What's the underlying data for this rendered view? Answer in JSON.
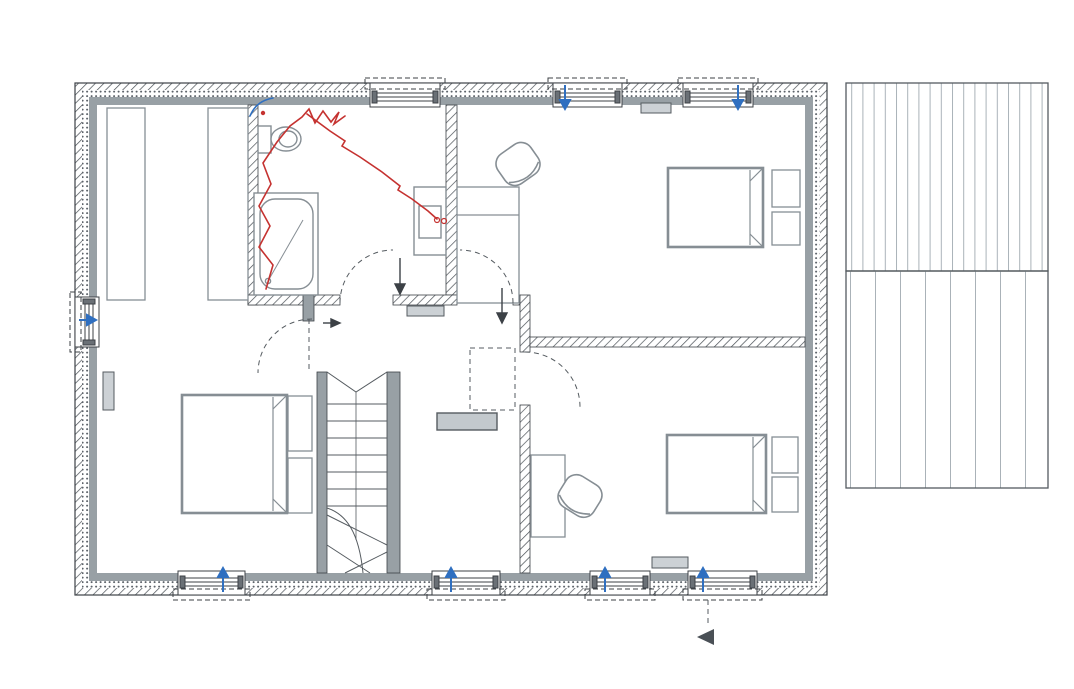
{
  "rooms": {
    "sdb": {
      "name": "SDB",
      "hs": "HS plaf. : 2.40",
      "area": "8,06 m²"
    },
    "chambre3": {
      "name": "CHAMBRE 3",
      "hs": "HS plaf. : 2.40",
      "area": "16,30 m²"
    },
    "chambre1": {
      "name_line1": "CHAMBRE 1",
      "name_line2": "+ DRESSING",
      "hs": "HS plaf. : 2.40",
      "area": "18,08 m²"
    },
    "hall": {
      "name": "HALL DE NUIT",
      "hs": "HS plaf. : 2.40",
      "area": "7,93 m²"
    },
    "coin_bureau": {
      "name": "COIN BUREAU",
      "hs": "HS plaf. : 2.40"
    },
    "chambre2": {
      "name": "CHAMBRE 2",
      "hs": "HS plaf. : 2.40",
      "area": "13,52 m²"
    }
  },
  "annotations": {
    "level": "NIV. + 2.71",
    "attic_line1": "Accès",
    "attic_line2": "grenier",
    "ridge": "faîtage",
    "total_width": "1.100",
    "total_height": "750"
  },
  "colors": {
    "wall_gray": "#98a0a5",
    "radiator_fill": "#ccd1d5",
    "marker_red": "#c53230",
    "marker_blue": "#2f6fc0",
    "level_box": "#c3c9cd"
  },
  "labels": [
    {
      "t": "432",
      "x": 237,
      "y": 34
    },
    {
      "t": "90",
      "x": 404,
      "y": 27
    },
    {
      "t": "95",
      "x": 404,
      "y": 40
    },
    {
      "t": "181",
      "x": 500,
      "y": 34
    },
    {
      "t": "90",
      "x": 589,
      "y": 27
    },
    {
      "t": "95",
      "x": 589,
      "y": 40
    },
    {
      "t": "100",
      "x": 650,
      "y": 34
    },
    {
      "t": "90",
      "x": 718,
      "y": 27
    },
    {
      "t": "95",
      "x": 718,
      "y": 40
    },
    {
      "t": "117",
      "x": 792,
      "y": 34
    },
    {
      "t": "37",
      "x": 95,
      "y": 59
    },
    {
      "t": "210",
      "x": 176,
      "y": 59
    },
    {
      "t": "10",
      "x": 251,
      "y": 49
    },
    {
      "t": "290",
      "x": 355,
      "y": 59
    },
    {
      "t": "10",
      "x": 458,
      "y": 49
    },
    {
      "t": "506",
      "x": 635,
      "y": 59
    },
    {
      "t": "37",
      "x": 810,
      "y": 59
    },
    {
      "t": "14",
      "x": 322,
      "y": 617
    },
    {
      "t": "10",
      "x": 522,
      "y": 617
    },
    {
      "t": "37",
      "x": 95,
      "y": 632
    },
    {
      "t": "310",
      "x": 213,
      "y": 632
    },
    {
      "t": "286",
      "x": 424,
      "y": 632
    },
    {
      "t": "406",
      "x": 664,
      "y": 632
    },
    {
      "t": "37",
      "x": 815,
      "y": 632
    },
    {
      "t": "147",
      "x": 132,
      "y": 651
    },
    {
      "t": "90",
      "x": 210,
      "y": 645
    },
    {
      "t": "95",
      "x": 210,
      "y": 658
    },
    {
      "t": "284",
      "x": 338,
      "y": 651
    },
    {
      "t": "90",
      "x": 464,
      "y": 645
    },
    {
      "t": "95",
      "x": 464,
      "y": 658
    },
    {
      "t": "139",
      "x": 545,
      "y": 651
    },
    {
      "t": "90",
      "x": 620,
      "y": 645
    },
    {
      "t": "95",
      "x": 620,
      "y": 658
    },
    {
      "t": "60",
      "x": 671,
      "y": 651
    },
    {
      "t": "14",
      "x": 703,
      "y": 651,
      "r": -90
    },
    {
      "t": "90",
      "x": 723,
      "y": 645
    },
    {
      "t": "95",
      "x": 723,
      "y": 658
    },
    {
      "t": "110",
      "x": 790,
      "y": 651
    },
    {
      "t": "1.100",
      "x": 455,
      "y": 677
    },
    {
      "t": "37",
      "x": 51,
      "y": 97,
      "r": -90
    },
    {
      "t": "330",
      "x": 31,
      "y": 181,
      "r": -90
    },
    {
      "t": "90",
      "x": 25,
      "y": 313,
      "r": -90
    },
    {
      "t": "215",
      "x": 36,
      "y": 316,
      "r": -90
    },
    {
      "t": "676",
      "x": 52,
      "y": 318,
      "r": -90
    },
    {
      "t": "330",
      "x": 31,
      "y": 438,
      "r": -90
    },
    {
      "t": "37",
      "x": 51,
      "y": 528,
      "r": -90
    },
    {
      "t": "37",
      "x": 853,
      "y": 97,
      "r": -90
    },
    {
      "t": "333",
      "x": 853,
      "y": 212,
      "r": -90
    },
    {
      "t": "10",
      "x": 843,
      "y": 318,
      "r": -90
    },
    {
      "t": "750",
      "x": 879,
      "y": 318,
      "r": -90
    },
    {
      "t": "333",
      "x": 853,
      "y": 431,
      "r": -90
    },
    {
      "t": "37",
      "x": 856,
      "y": 536,
      "r": -90
    },
    {
      "t": "10",
      "x": 253,
      "y": 121
    },
    {
      "t": "170",
      "x": 311,
      "y": 131
    },
    {
      "t": "124",
      "x": 299,
      "y": 157,
      "r": -90
    },
    {
      "t": "100",
      "x": 408,
      "y": 127
    },
    {
      "t": "100",
      "x": 408,
      "y": 140
    },
    {
      "t": "20",
      "x": 442,
      "y": 124
    },
    {
      "t": "10",
      "x": 463,
      "y": 124
    },
    {
      "t": "141",
      "x": 507,
      "y": 131
    },
    {
      "t": "100",
      "x": 590,
      "y": 127
    },
    {
      "t": "100",
      "x": 590,
      "y": 140
    },
    {
      "t": "90",
      "x": 655,
      "y": 131
    },
    {
      "t": "100",
      "x": 718,
      "y": 127
    },
    {
      "t": "100",
      "x": 718,
      "y": 140
    },
    {
      "t": "75",
      "x": 779,
      "y": 131
    },
    {
      "t": "HT 200",
      "x": 750,
      "y": 155,
      "s": 9.5,
      "n": "height-note"
    },
    {
      "t": "limite plafond",
      "x": 576,
      "y": 184,
      "s": 10,
      "n": "ceiling-limit-note"
    },
    {
      "t": "288",
      "x": 131,
      "y": 210,
      "r": -90
    },
    {
      "t": "278",
      "x": 339,
      "y": 206,
      "r": -90
    },
    {
      "t": "278",
      "x": 554,
      "y": 209,
      "r": -90
    },
    {
      "t": "333",
      "x": 768,
      "y": 223,
      "r": -90
    },
    {
      "t": "14",
      "x": 289,
      "y": 198,
      "r": -90,
      "s": 9.5
    },
    {
      "t": "80",
      "x": 300,
      "y": 227,
      "r": -90
    },
    {
      "t": "10",
      "x": 252,
      "y": 266,
      "s": 10
    },
    {
      "t": "14",
      "x": 317,
      "y": 267,
      "s": 10
    },
    {
      "t": "20",
      "x": 339,
      "y": 269,
      "s": 10
    },
    {
      "t": "90",
      "x": 287,
      "y": 280,
      "s": 10
    },
    {
      "t": "60",
      "x": 303,
      "y": 279,
      "r": -90,
      "s": 10
    },
    {
      "t": "10",
      "x": 289,
      "y": 293,
      "r": -90,
      "s": 10
    },
    {
      "t": "80",
      "x": 366,
      "y": 272
    },
    {
      "t": "205",
      "x": 367,
      "y": 284
    },
    {
      "t": "86",
      "x": 427,
      "y": 280
    },
    {
      "t": "10",
      "x": 450,
      "y": 267
    },
    {
      "t": "5",
      "x": 466,
      "y": 267
    },
    {
      "t": "80",
      "x": 491,
      "y": 272
    },
    {
      "t": "205",
      "x": 492,
      "y": 284
    },
    {
      "t": "55",
      "x": 553,
      "y": 318,
      "r": -90
    },
    {
      "t": "10",
      "x": 541,
      "y": 331,
      "r": -90
    },
    {
      "t": "10",
      "x": 540,
      "y": 353,
      "s": 10
    },
    {
      "t": "702",
      "x": 566,
      "y": 359
    },
    {
      "t": "80",
      "x": 550,
      "y": 377,
      "r": -90
    },
    {
      "t": "205",
      "x": 562,
      "y": 377,
      "r": -90
    },
    {
      "t": "10",
      "x": 757,
      "y": 338,
      "r": -90
    },
    {
      "t": "10",
      "x": 288,
      "y": 317,
      "r": -90,
      "s": 10
    },
    {
      "t": "80",
      "x": 306,
      "y": 338,
      "r": -90
    },
    {
      "t": "205",
      "x": 317,
      "y": 338,
      "r": -90
    },
    {
      "t": "14",
      "x": 323,
      "y": 347,
      "s": 9.5
    },
    {
      "t": "100",
      "x": 281,
      "y": 359
    },
    {
      "t": "100",
      "x": 126,
      "y": 342,
      "r": -90
    },
    {
      "t": "220",
      "x": 137,
      "y": 342,
      "r": -90
    },
    {
      "t": "288",
      "x": 131,
      "y": 473,
      "r": -90
    },
    {
      "t": "298",
      "x": 300,
      "y": 471,
      "r": -90
    },
    {
      "t": "388",
      "x": 342,
      "y": 437,
      "r": -90
    },
    {
      "t": "243",
      "x": 553,
      "y": 489,
      "r": -90
    },
    {
      "t": "333",
      "x": 767,
      "y": 465,
      "r": -90
    },
    {
      "t": "155",
      "x": 381,
      "y": 551
    },
    {
      "t": "14",
      "x": 321,
      "y": 539,
      "s": 10
    },
    {
      "t": "HT 200",
      "x": 127,
      "y": 529,
      "s": 9.5,
      "n": "height-note"
    },
    {
      "t": "HT 200",
      "x": 748,
      "y": 530,
      "s": 9.5,
      "n": "height-note"
    },
    {
      "t": "limite plafond",
      "x": 482,
      "y": 501,
      "s": 10,
      "n": "ceiling-limit-note"
    },
    {
      "t": "105",
      "x": 145,
      "y": 553
    },
    {
      "t": "100",
      "x": 212,
      "y": 546
    },
    {
      "t": "100",
      "x": 212,
      "y": 559
    },
    {
      "t": "105",
      "x": 283,
      "y": 553
    },
    {
      "t": "100",
      "x": 467,
      "y": 546
    },
    {
      "t": "100",
      "x": 467,
      "y": 559
    },
    {
      "t": "31",
      "x": 507,
      "y": 552
    },
    {
      "t": "10",
      "x": 522,
      "y": 540,
      "r": -90
    },
    {
      "t": "88",
      "x": 556,
      "y": 554
    },
    {
      "t": "100",
      "x": 620,
      "y": 546
    },
    {
      "t": "100",
      "x": 620,
      "y": 559
    },
    {
      "t": "50",
      "x": 671,
      "y": 551
    },
    {
      "t": "100",
      "x": 724,
      "y": 546
    },
    {
      "t": "100",
      "x": 724,
      "y": 559
    },
    {
      "t": "68",
      "x": 780,
      "y": 553
    },
    {
      "t": "HA 45",
      "x": 413,
      "y": 107,
      "s": 9.5,
      "n": "window-label"
    },
    {
      "t": "HA 45",
      "x": 591,
      "y": 107,
      "s": 9.5,
      "n": "window-label"
    },
    {
      "t": "HA 45",
      "x": 714,
      "y": 106,
      "s": 9.5,
      "n": "window-label"
    },
    {
      "t": "HA 45",
      "x": 213,
      "y": 567,
      "s": 9.5,
      "n": "window-label"
    },
    {
      "t": "HA 45",
      "x": 477,
      "y": 568,
      "s": 9.5,
      "n": "window-label"
    },
    {
      "t": "HA 45",
      "x": 638,
      "y": 566,
      "s": 9.5,
      "n": "window-label"
    },
    {
      "t": "HA 45",
      "x": 735,
      "y": 569,
      "s": 9.5,
      "n": "window-label"
    },
    {
      "t": "R",
      "x": 656,
      "y": 111,
      "s": 8,
      "n": "radiator-label"
    },
    {
      "t": "R",
      "x": 425,
      "y": 314,
      "s": 8,
      "n": "radiator-label"
    },
    {
      "t": "R",
      "x": 670,
      "y": 566,
      "s": 8,
      "n": "radiator-label"
    },
    {
      "t": "R",
      "x": 109,
      "y": 392,
      "s": 8,
      "r": -90,
      "n": "radiator-label"
    }
  ],
  "stairs": {
    "steps": [
      {
        "t": "14",
        "x": 354,
        "y": 388
      },
      {
        "t": "13",
        "x": 354,
        "y": 404
      },
      {
        "t": "12",
        "x": 354,
        "y": 421
      },
      {
        "t": "11",
        "x": 354,
        "y": 437
      },
      {
        "t": "10",
        "x": 354,
        "y": 453
      },
      {
        "t": "9",
        "x": 354,
        "y": 470
      },
      {
        "t": "8",
        "x": 354,
        "y": 486
      },
      {
        "t": "7",
        "x": 352,
        "y": 502
      },
      {
        "t": "6",
        "x": 354,
        "y": 518
      },
      {
        "t": "5",
        "x": 356,
        "y": 533
      },
      {
        "t": "4",
        "x": 369,
        "y": 548
      },
      {
        "t": "3",
        "x": 384,
        "y": 551
      }
    ]
  }
}
